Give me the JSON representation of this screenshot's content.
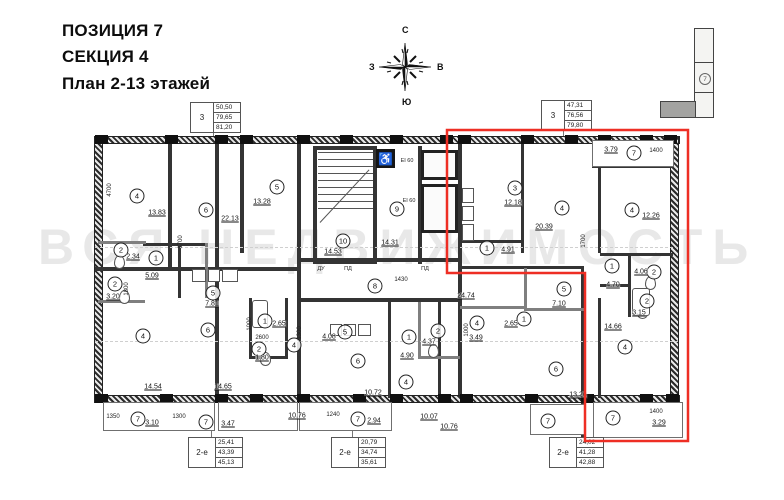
{
  "header": {
    "line1": "ПОЗИЦИЯ 7",
    "line2": "СЕКЦИЯ 4",
    "line3": "План 2-13 этажей"
  },
  "compass": {
    "north": "С",
    "south": "Ю",
    "west": "З",
    "east": "В"
  },
  "locator": {
    "position_label": "7"
  },
  "watermark": "ВСЯ НЕДВИЖИМОСТЬ",
  "tables": [
    {
      "label": "3",
      "values": [
        "50,50",
        "79,65",
        "81,20"
      ]
    },
    {
      "label": "3",
      "values": [
        "47,31",
        "76,56",
        "79,80"
      ]
    },
    {
      "label": "2-е",
      "values": [
        "25,41",
        "43,39",
        "45,13"
      ]
    },
    {
      "label": "2-е",
      "values": [
        "20,79",
        "34,74",
        "35,61"
      ]
    },
    {
      "label": "2-е",
      "values": [
        "24,02",
        "41,28",
        "42,88"
      ]
    }
  ],
  "chart_data": {
    "type": "floor-plan",
    "highlight_color": "#ee2e24",
    "rooms": [
      {
        "n": "4",
        "x": 137,
        "y": 196,
        "area": "13.83",
        "ax": 157,
        "ay": 213
      },
      {
        "n": "6",
        "x": 206,
        "y": 210,
        "area": "22.13",
        "ax": 230,
        "ay": 219
      },
      {
        "n": "5",
        "x": 277,
        "y": 187,
        "area": "13.28",
        "ax": 262,
        "ay": 202
      },
      {
        "n": "2",
        "x": 121,
        "y": 250,
        "area": "2.34",
        "ax": 133,
        "ay": 257
      },
      {
        "n": "1",
        "x": 156,
        "y": 258,
        "area": "5.09",
        "ax": 152,
        "ay": 276
      },
      {
        "n": "2",
        "x": 115,
        "y": 284,
        "area": "3.20",
        "ax": 113,
        "ay": 297
      },
      {
        "n": "5",
        "x": 213,
        "y": 293,
        "area": "7.81",
        "ax": 212,
        "ay": 304
      },
      {
        "n": "4",
        "x": 143,
        "y": 336,
        "area": "14.54",
        "ax": 153,
        "ay": 387
      },
      {
        "n": "6",
        "x": 208,
        "y": 330,
        "area": "14.65",
        "ax": 223,
        "ay": 387
      },
      {
        "n": "1",
        "x": 265,
        "y": 321,
        "area": "2.65",
        "ax": 279,
        "ay": 324
      },
      {
        "n": "2",
        "x": 259,
        "y": 349,
        "area": "1.80",
        "ax": 262,
        "ay": 358
      },
      {
        "n": "7",
        "x": 138,
        "y": 419,
        "area": "3.10",
        "ax": 152,
        "ay": 423
      },
      {
        "n": "7",
        "x": 206,
        "y": 422,
        "area": "3.47",
        "ax": 228,
        "ay": 424
      },
      {
        "n": "4",
        "x": 294,
        "y": 345,
        "area": "10.76",
        "ax": 297,
        "ay": 416
      },
      {
        "n": "5",
        "x": 345,
        "y": 332,
        "area": "4.08",
        "ax": 329,
        "ay": 337
      },
      {
        "n": "6",
        "x": 358,
        "y": 361,
        "area": "10.72",
        "ax": 373,
        "ay": 393
      },
      {
        "n": "1",
        "x": 409,
        "y": 337,
        "area": "4.90",
        "ax": 407,
        "ay": 356
      },
      {
        "n": "2",
        "x": 438,
        "y": 331,
        "area": "4.37",
        "ax": 429,
        "ay": 342
      },
      {
        "n": "4",
        "x": 406,
        "y": 382,
        "area": "10.07",
        "ax": 429,
        "ay": 417
      },
      {
        "n": "7",
        "x": 358,
        "y": 419,
        "area": "2.94",
        "ax": 374,
        "ay": 421
      },
      {
        "n": "8",
        "x": 375,
        "y": 286,
        "area": "",
        "ax": 0,
        "ay": 0
      },
      {
        "n": "10",
        "x": 343,
        "y": 241,
        "area": "14.53",
        "ax": 333,
        "ay": 252
      },
      {
        "n": "9",
        "x": 397,
        "y": 209,
        "area": "14.31",
        "ax": 390,
        "ay": 243
      },
      {
        "n": "3",
        "x": 515,
        "y": 188,
        "area": "12.18",
        "ax": 513,
        "ay": 203
      },
      {
        "n": "4",
        "x": 562,
        "y": 208,
        "area": "20.39",
        "ax": 544,
        "ay": 227
      },
      {
        "n": "1",
        "x": 487,
        "y": 248,
        "area": "4.91",
        "ax": 508,
        "ay": 250
      },
      {
        "n": "4",
        "x": 632,
        "y": 210,
        "area": "12.26",
        "ax": 651,
        "ay": 216
      },
      {
        "n": "7",
        "x": 634,
        "y": 153,
        "area": "3.79",
        "ax": 611,
        "ay": 150
      },
      {
        "n": "1",
        "x": 612,
        "y": 266,
        "area": "4.70",
        "ax": 613,
        "ay": 285
      },
      {
        "n": "2",
        "x": 654,
        "y": 272,
        "area": "4.06",
        "ax": 641,
        "ay": 272
      },
      {
        "n": "2",
        "x": 647,
        "y": 301,
        "area": "3.15",
        "ax": 639,
        "ay": 313
      },
      {
        "n": "4",
        "x": 625,
        "y": 347,
        "area": "14.66",
        "ax": 613,
        "ay": 327
      },
      {
        "n": "7",
        "x": 613,
        "y": 418,
        "area": "3.29",
        "ax": 659,
        "ay": 423
      },
      {
        "n": "5",
        "x": 564,
        "y": 289,
        "area": "7.10",
        "ax": 559,
        "ay": 304
      },
      {
        "n": "1",
        "x": 524,
        "y": 319,
        "area": "2.65",
        "ax": 511,
        "ay": 324
      },
      {
        "n": "4",
        "x": 477,
        "y": 323,
        "area": "3.49",
        "ax": 476,
        "ay": 338
      },
      {
        "n": "6",
        "x": 556,
        "y": 369,
        "area": "13.26",
        "ax": 578,
        "ay": 395
      },
      {
        "n": "7",
        "x": 548,
        "y": 421,
        "area": "",
        "ax": 0,
        "ay": 0
      },
      {
        "n": "",
        "x": 0,
        "y": 0,
        "area": "24.74",
        "ax": 466,
        "ay": 296
      },
      {
        "n": "",
        "x": 0,
        "y": 0,
        "area": "10.76",
        "ax": 449,
        "ay": 427
      }
    ],
    "dims": [
      {
        "t": "4700",
        "x": 110,
        "y": 190,
        "v": true
      },
      {
        "t": "1700",
        "x": 181,
        "y": 242,
        "v": true
      },
      {
        "t": "1800",
        "x": 127,
        "y": 289,
        "v": true
      },
      {
        "t": "1000",
        "x": 250,
        "y": 324,
        "v": true
      },
      {
        "t": "2600",
        "x": 262,
        "y": 338,
        "v": false
      },
      {
        "t": "1350",
        "x": 113,
        "y": 417,
        "v": false
      },
      {
        "t": "1300",
        "x": 179,
        "y": 417,
        "v": false
      },
      {
        "t": "1240",
        "x": 333,
        "y": 415,
        "v": false
      },
      {
        "t": "1430",
        "x": 401,
        "y": 280,
        "v": false
      },
      {
        "t": "1300",
        "x": 300,
        "y": 333,
        "v": true
      },
      {
        "t": "1000",
        "x": 467,
        "y": 330,
        "v": true
      },
      {
        "t": "1700",
        "x": 584,
        "y": 241,
        "v": true
      },
      {
        "t": "1400",
        "x": 656,
        "y": 151,
        "v": false
      },
      {
        "t": "1400",
        "x": 656,
        "y": 412,
        "v": false
      }
    ],
    "notes": [
      {
        "t": "EI 60",
        "x": 407,
        "y": 161
      },
      {
        "t": "EI 60",
        "x": 409,
        "y": 201
      },
      {
        "t": "ДУ",
        "x": 321,
        "y": 269
      },
      {
        "t": "ПД",
        "x": 348,
        "y": 269
      },
      {
        "t": "ПД",
        "x": 425,
        "y": 269
      }
    ]
  }
}
